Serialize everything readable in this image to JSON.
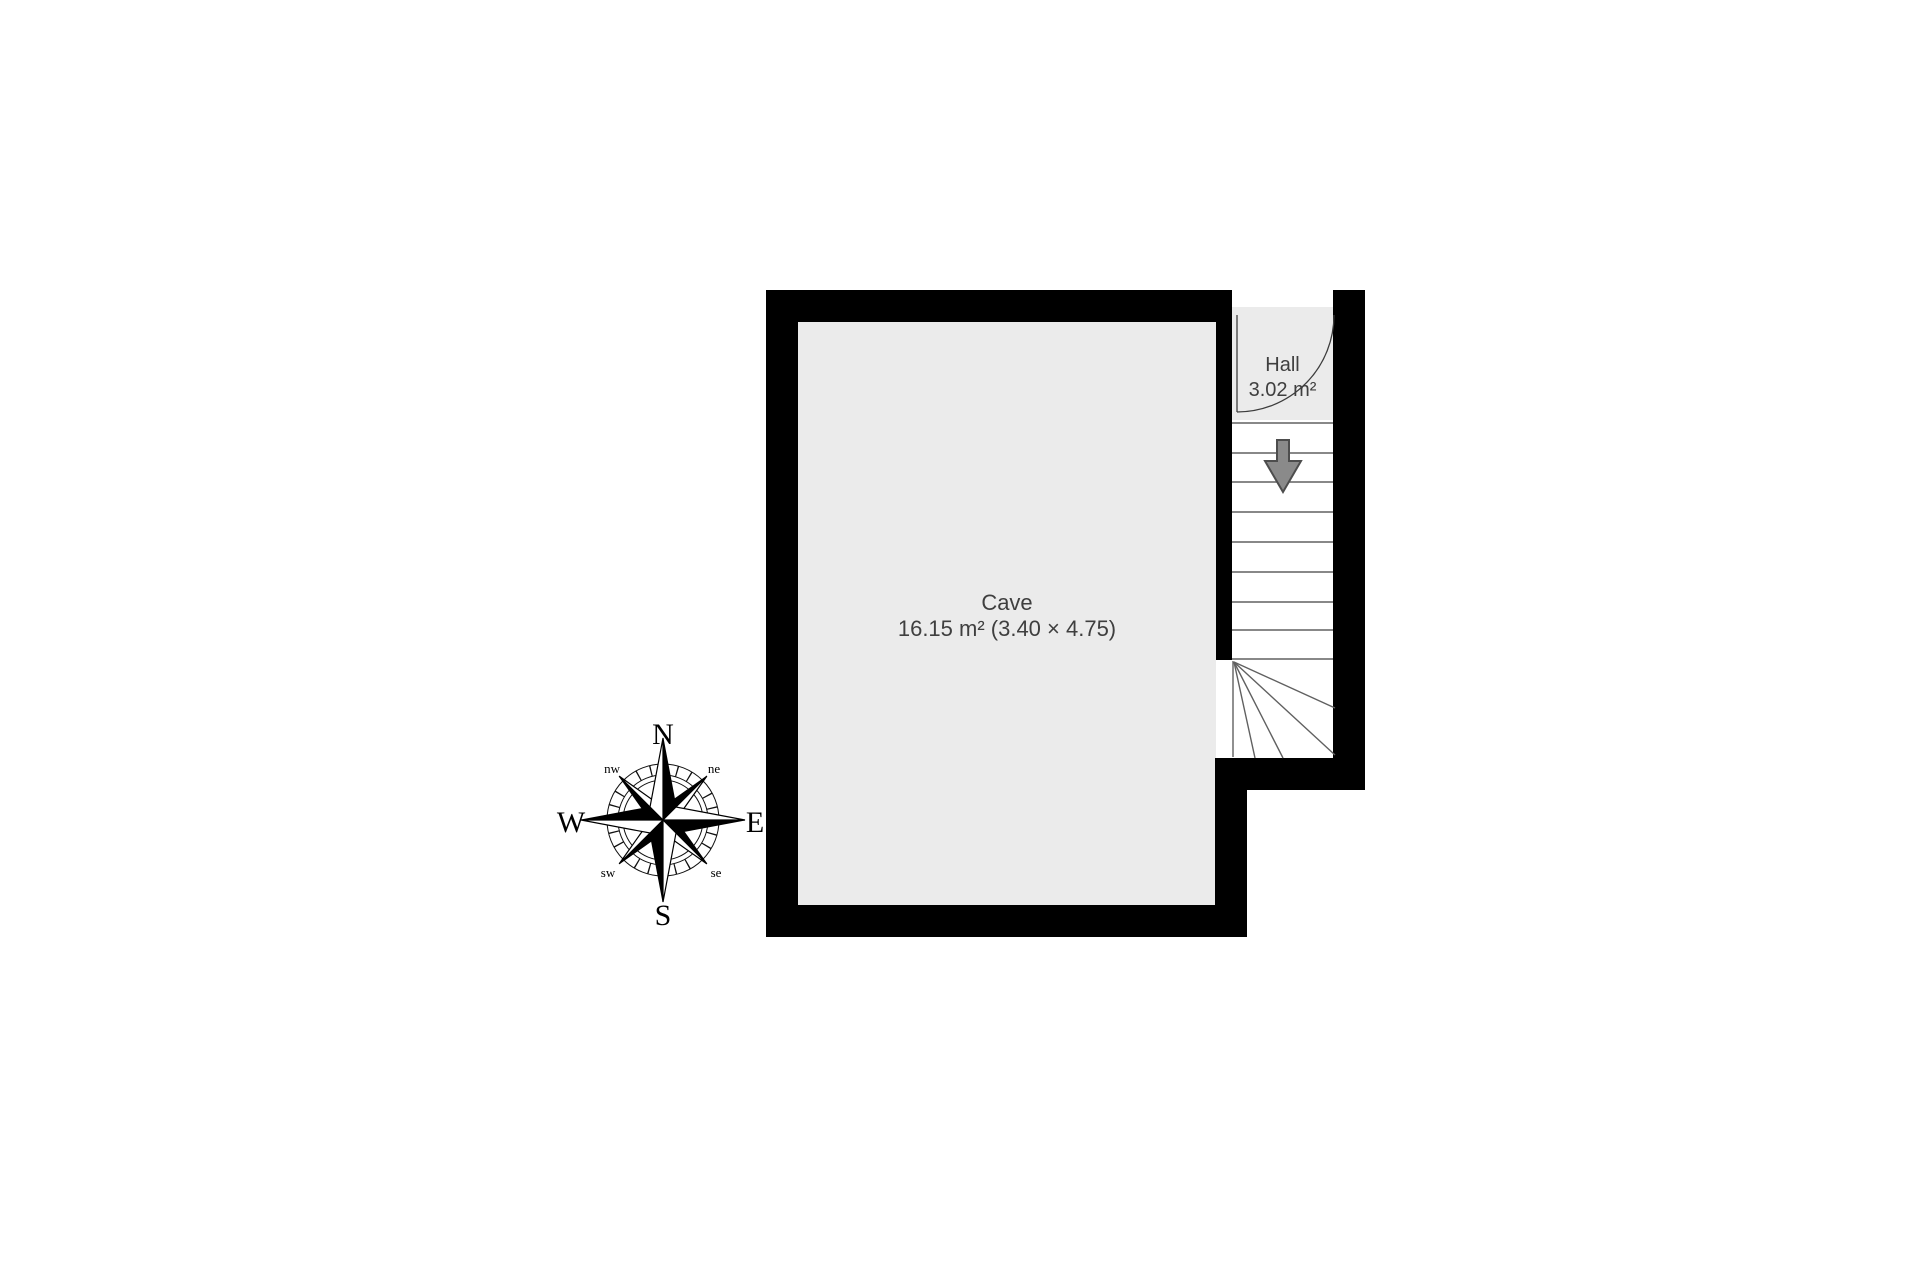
{
  "floor_plan": {
    "rooms": {
      "cave": {
        "name": "Cave",
        "details": "16.15 m² (3.40 × 4.75)"
      },
      "hall": {
        "name": "Hall",
        "details": "3.02 m²"
      }
    },
    "stairs": {
      "direction": "down",
      "straight_steps": 10,
      "winder_steps": 5
    },
    "colors": {
      "wall": "#000000",
      "floor": "#ebebeb",
      "stairs": "#ffffff",
      "outline": "#606060",
      "label": "#3f3f3f",
      "arrow_fill": "#8a8a8a",
      "arrow_stroke": "#4d4d4d",
      "background": "#ffffff"
    }
  },
  "compass": {
    "n": "N",
    "e": "E",
    "s": "S",
    "w": "W",
    "nw": "nw",
    "ne": "ne",
    "sw": "sw",
    "se": "se"
  }
}
